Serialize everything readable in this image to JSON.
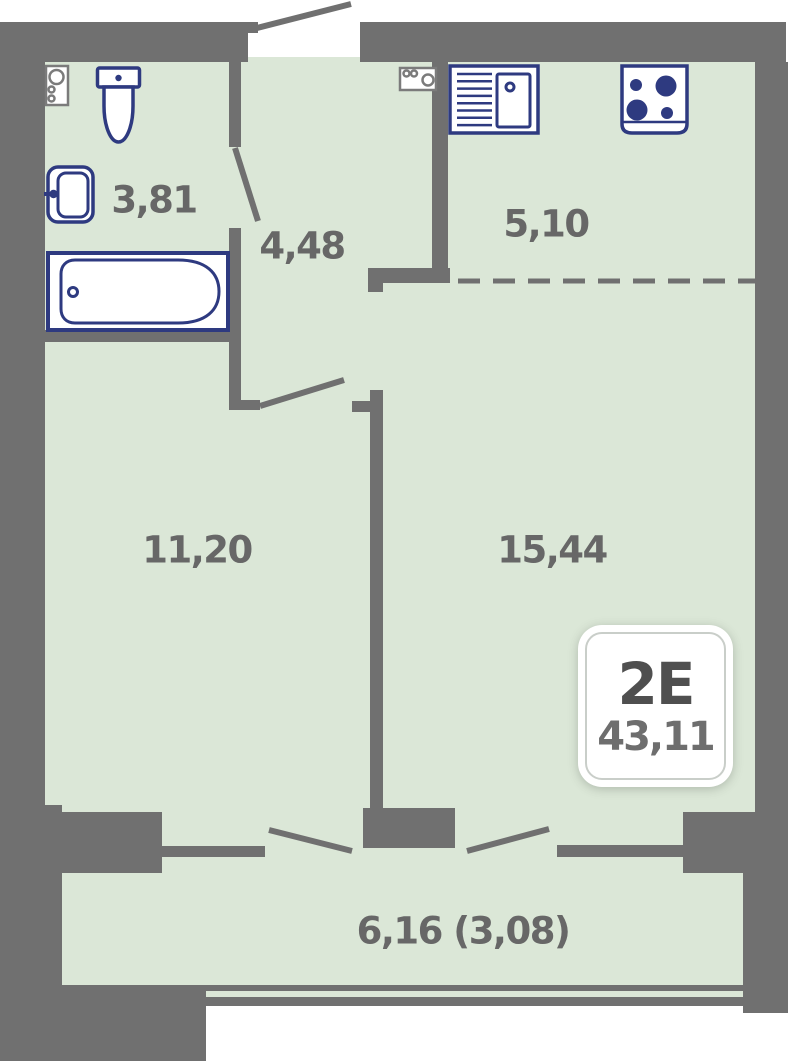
{
  "plan_title": "apartment-floor-plan",
  "rooms": {
    "bathroom": "3,81",
    "hallway": "4,48",
    "kitchen": "5,10",
    "bedroom": "11,20",
    "living": "15,44",
    "balcony": "6,16 (3,08)"
  },
  "badge": {
    "type": "2E",
    "area": "43,11"
  },
  "icons": [
    "water-heater-icon",
    "toilet-icon",
    "washbasin-icon",
    "bathtub-icon",
    "kitchen-sink-icon",
    "stove-icon",
    "appliance-icon",
    "door-swing-icon",
    "kitchen-zone-dashed-divider"
  ],
  "colors": {
    "wall": "#707070",
    "floor": "#dbe7d7",
    "fixture_navy": "#2e3a80",
    "appliance_gray": "#7b7b7b",
    "label_gray": "#676767",
    "badge_border": "#c9cec9",
    "background": "#ffffff"
  }
}
